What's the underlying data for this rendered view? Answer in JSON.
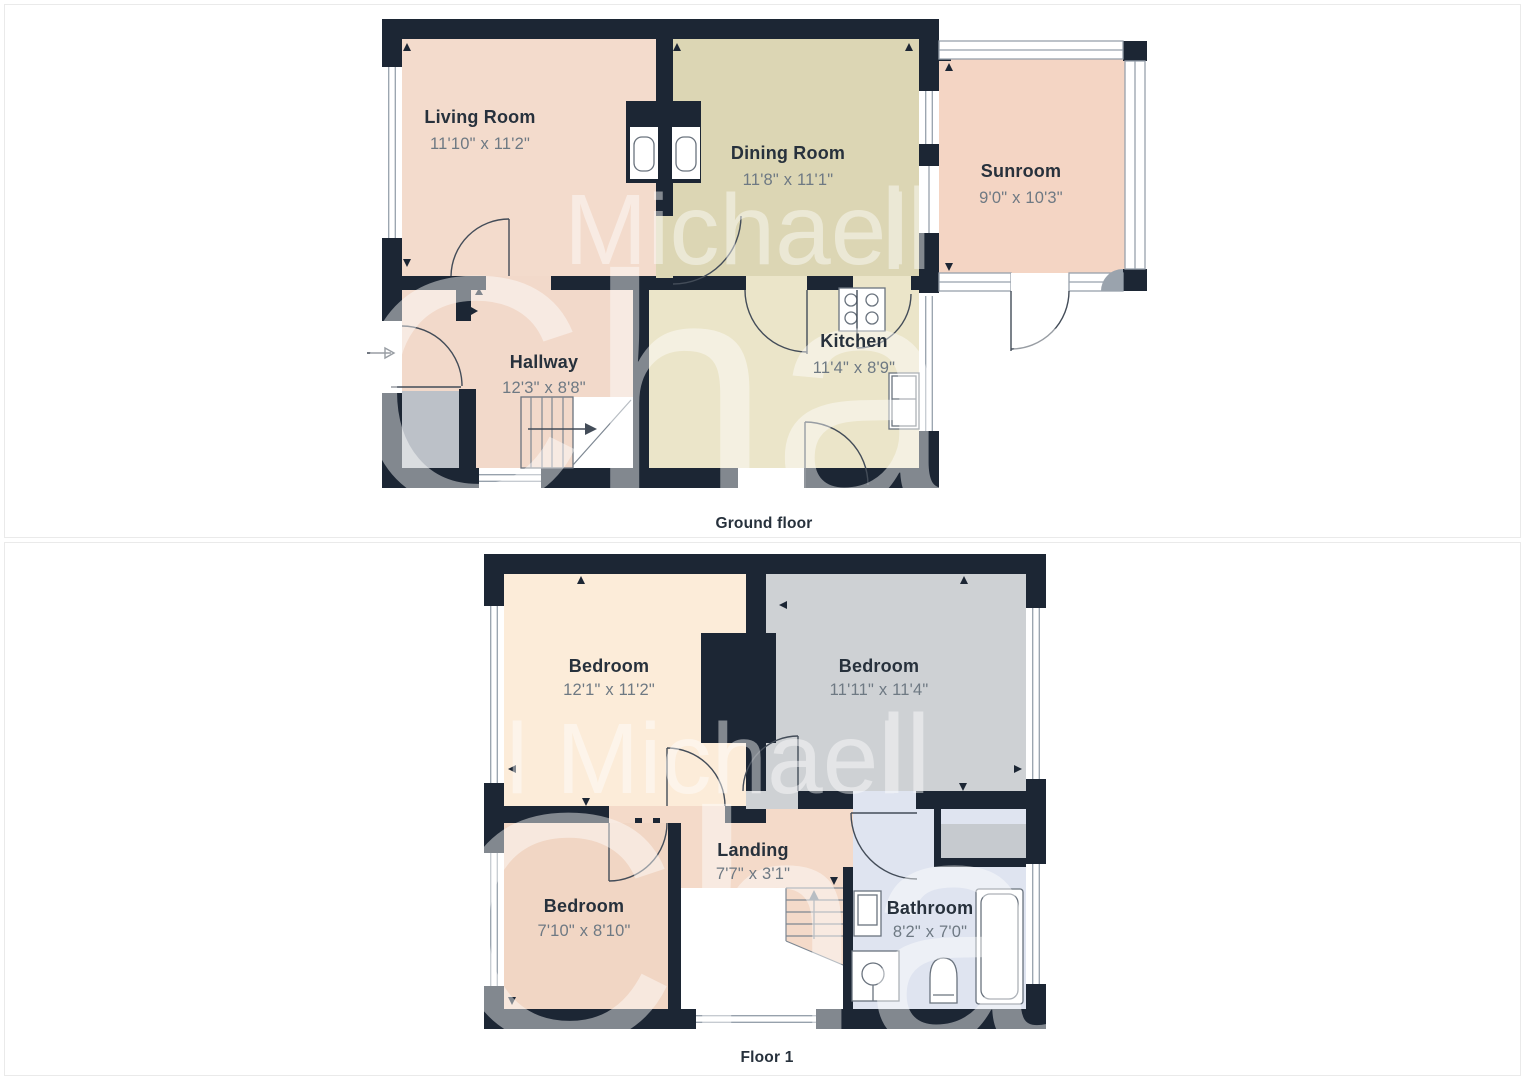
{
  "colors": {
    "wall": "#1c2634",
    "living": "#f3dbcc",
    "dining": "#dcd6b4",
    "kitchen": "#ebe5c9",
    "hallway": "#f2d9ca",
    "sunroom": "#f4d5c4",
    "bedroom_main": "#fcecd9",
    "bedroom_grey": "#ced1d4",
    "bedroom_small": "#f1d6c4",
    "landing": "#f4dac9",
    "bathroom": "#dfe4f0",
    "porch": "#bcc1c8",
    "cupboard": "#c6cacf",
    "corner_shade": "#9aa3ad",
    "label": "#27313c",
    "dims": "#6e7983",
    "watermark": "#ffffff"
  },
  "watermark": {
    "first": "Michael",
    "lead": "l Michael",
    "tail": "ll",
    "surname": "Chandler"
  },
  "floors": [
    {
      "caption": "Ground floor",
      "rooms": [
        {
          "name": "Living Room",
          "dims": "11'10\" x 11'2\""
        },
        {
          "name": "Dining Room",
          "dims": "11'8\" x 11'1\""
        },
        {
          "name": "Sunroom",
          "dims": "9'0\" x 10'3\""
        },
        {
          "name": "Hallway",
          "dims": "12'3\" x 8'8\""
        },
        {
          "name": "Kitchen",
          "dims": "11'4\" x 8'9\""
        }
      ]
    },
    {
      "caption": "Floor 1",
      "rooms": [
        {
          "name": "Bedroom",
          "dims": "12'1\" x 11'2\""
        },
        {
          "name": "Bedroom",
          "dims": "11'11\" x 11'4\""
        },
        {
          "name": "Bedroom",
          "dims": "7'10\" x 8'10\""
        },
        {
          "name": "Landing",
          "dims": "7'7\" x 3'1\""
        },
        {
          "name": "Bathroom",
          "dims": "8'2\" x 7'0\""
        }
      ]
    }
  ]
}
